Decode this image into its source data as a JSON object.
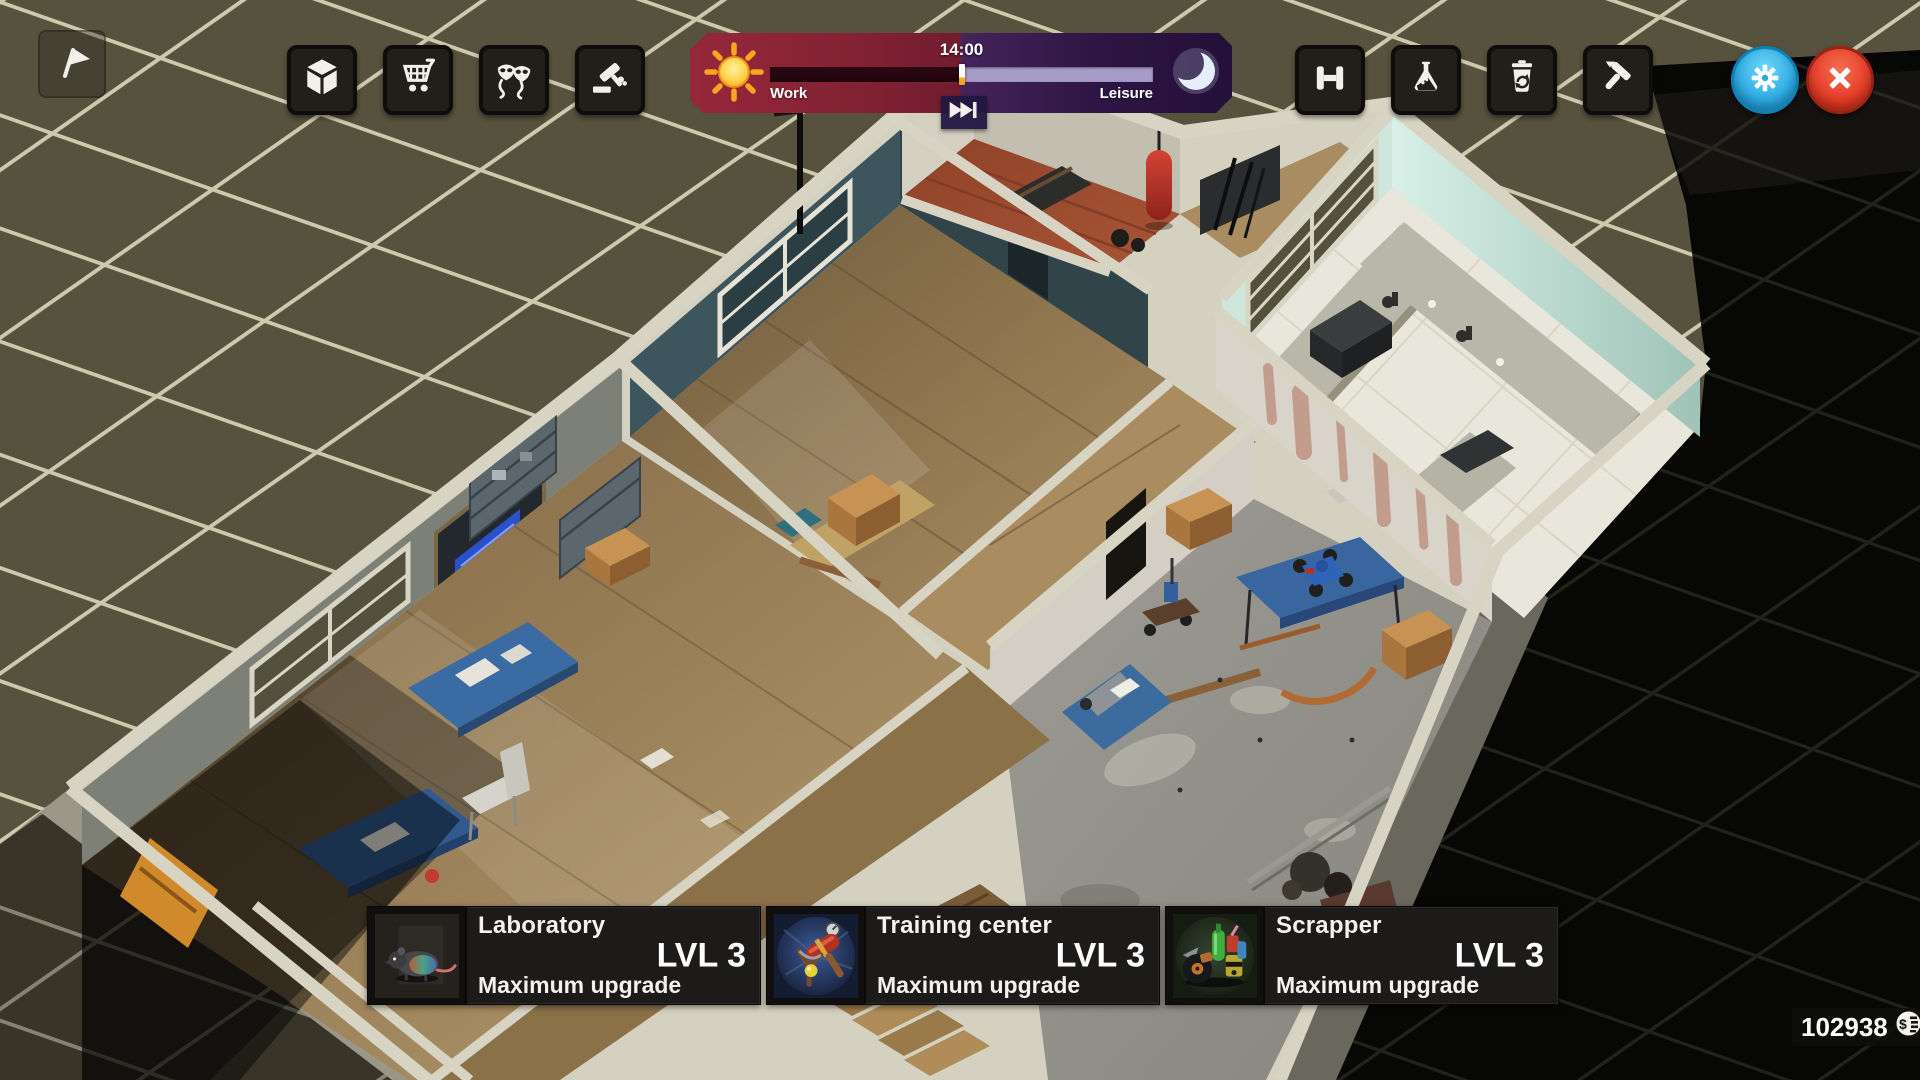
{
  "hud": {
    "flag_button": {
      "name": "objectives",
      "icon": "flag-icon"
    },
    "toolbar_left": [
      {
        "name": "storage",
        "icon": "cube-icon"
      },
      {
        "name": "shop",
        "icon": "cart-icon"
      },
      {
        "name": "disguise",
        "icon": "masks-icon"
      },
      {
        "name": "auction",
        "icon": "gavel-icon"
      }
    ],
    "time_panel": {
      "time": "14:00",
      "work_label": "Work",
      "leisure_label": "Leisure",
      "progress_pct": 50,
      "work_color": "#8f2433",
      "leisure_color": "#3a1d4e",
      "track_color": "#a79bc8",
      "fill_color": "#2a0711",
      "marker_color": "#ffffff",
      "sun_icon": "sun-icon",
      "moon_icon": "moon-icon",
      "skip_icon": "skip-forward-icon"
    },
    "toolbar_right": [
      {
        "name": "training",
        "icon": "dumbbell-icon"
      },
      {
        "name": "laboratory",
        "icon": "flask-icon"
      },
      {
        "name": "scrapper",
        "icon": "recycle-bin-icon"
      },
      {
        "name": "build",
        "icon": "hammer-icon"
      }
    ],
    "settings_button": {
      "name": "settings",
      "icon": "gear-icon",
      "color": "#35b9ea"
    },
    "close_button": {
      "name": "close",
      "icon": "close-icon",
      "color": "#ea3d2a"
    },
    "room_panels": [
      {
        "title": "Laboratory",
        "level": "LVL 3",
        "status": "Maximum upgrade",
        "icon": "rat-icon"
      },
      {
        "title": "Training center",
        "level": "LVL 3",
        "status": "Maximum upgrade",
        "icon": "mallet-slingshot-icon"
      },
      {
        "title": "Scrapper",
        "level": "LVL 3",
        "status": "Maximum upgrade",
        "icon": "junk-pile-icon"
      }
    ],
    "currency": {
      "amount": "102938",
      "icon": "coin-icon"
    }
  },
  "scene": {
    "ground": "dark-olive-tiles",
    "rooms_visible": [
      "office",
      "workshop",
      "training-center",
      "laboratory",
      "scrapper",
      "corridor"
    ]
  }
}
